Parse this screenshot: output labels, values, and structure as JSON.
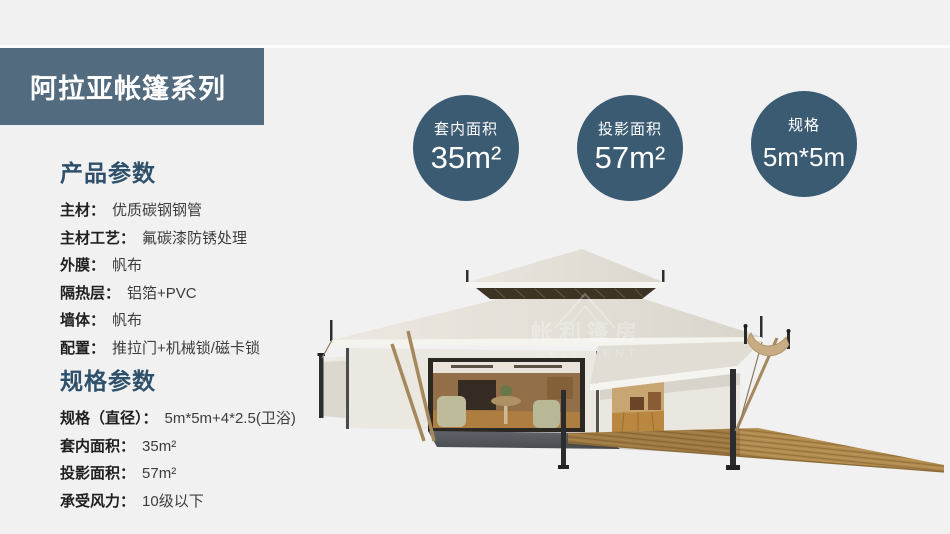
{
  "page": {
    "background": "#f1f1f2"
  },
  "banner": {
    "title": "阿拉亚帐篷系列",
    "bg_color": "#536b7e"
  },
  "badges": [
    {
      "label": "套内面积",
      "value": "35m²"
    },
    {
      "label": "投影面积",
      "value": "57m²"
    },
    {
      "label": "规格",
      "value": "5m*5m"
    }
  ],
  "product_params": {
    "heading": "产品参数",
    "rows": [
      {
        "label": "主材：",
        "value": "优质碳钢钢管"
      },
      {
        "label": "主材工艺：",
        "value": "氟碳漆防锈处理"
      },
      {
        "label": "外膜：",
        "value": "帆布"
      },
      {
        "label": "隔热层：",
        "value": "铝箔+PVC"
      },
      {
        "label": "墙体：",
        "value": "帆布"
      },
      {
        "label": "配置：",
        "value": "推拉门+机械锁/磁卡锁"
      }
    ]
  },
  "spec_params": {
    "heading": "规格参数",
    "rows": [
      {
        "label": "规格（直径）：",
        "value": "5m*5m+4*2.5(卫浴)"
      },
      {
        "label": "套内面积：",
        "value": "35m²"
      },
      {
        "label": "投影面积：",
        "value": "57m²"
      },
      {
        "label": "承受风力：",
        "value": "10级以下"
      }
    ]
  },
  "watermark": {
    "cn": "帐利篷房",
    "en": "WELL TENT"
  },
  "colors": {
    "banner_bg": "#536b7e",
    "badge_bg": "#3b5b72",
    "heading": "#2e506b",
    "roof_cream": "#e7e3dc",
    "deck_wood": "#b08a4e"
  }
}
